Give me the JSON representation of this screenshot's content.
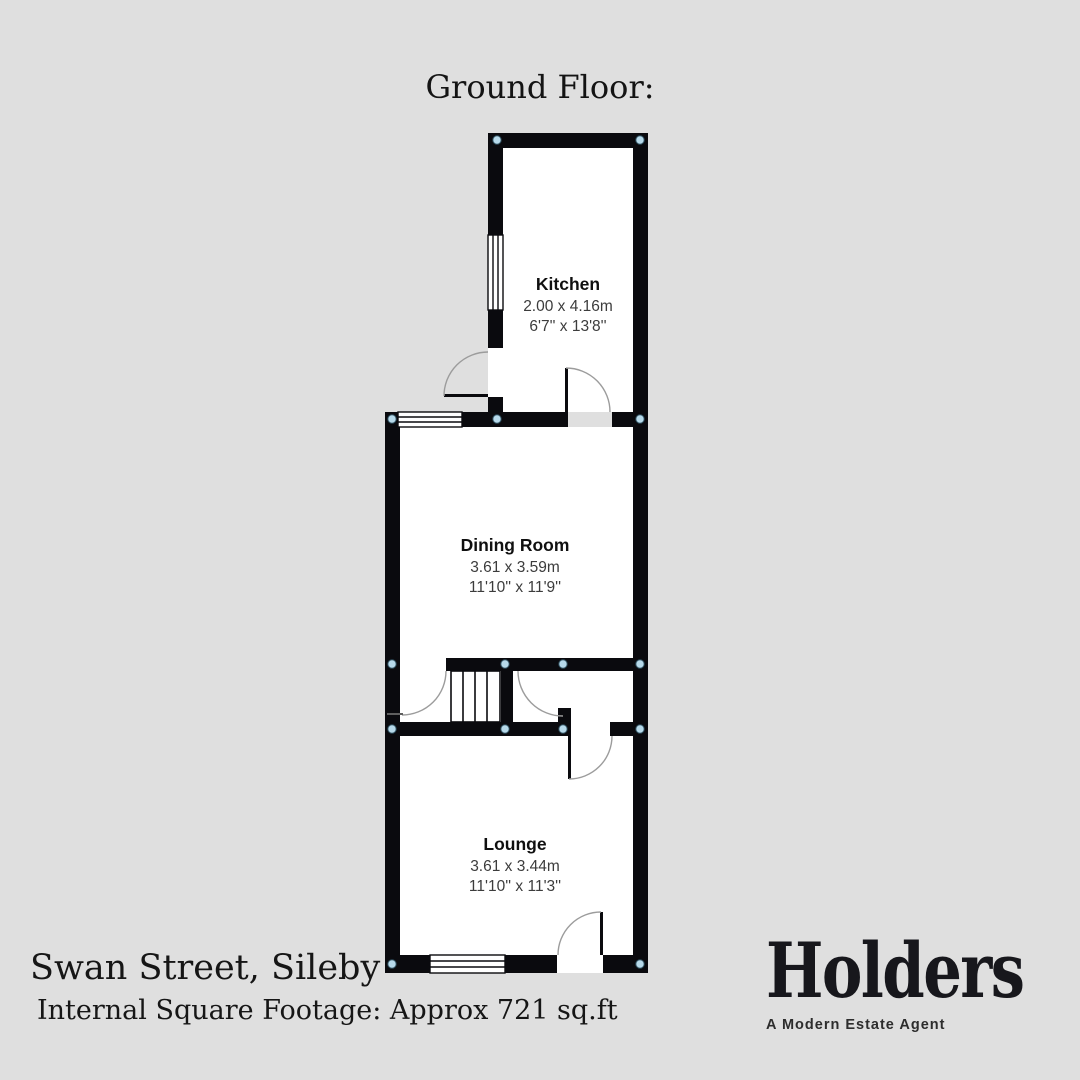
{
  "title": "Ground Floor:",
  "rooms": {
    "kitchen": {
      "name": "Kitchen",
      "metric": "2.00 x 4.16m",
      "imperial": "6'7'' x 13'8''"
    },
    "dining": {
      "name": "Dining Room",
      "metric": "3.61 x 3.59m",
      "imperial": "11'10'' x 11'9''"
    },
    "lounge": {
      "name": "Lounge",
      "metric": "3.61 x 3.44m",
      "imperial": "11'10'' x 11'3''"
    }
  },
  "footer": {
    "address": "Swan Street, Sileby",
    "footage": "Internal Square Footage: Approx 721 sq.ft"
  },
  "brand": {
    "name": "Holders",
    "tagline": "A Modern Estate Agent"
  },
  "colors": {
    "background": "#dfdfdf",
    "wall": "#0a0a0e",
    "floor": "#ffffff",
    "marker": "#b6d9ea",
    "marker_ring": "#2f4f5e",
    "door_arc": "#9c9c9c",
    "brand_ink": "#17171c"
  }
}
